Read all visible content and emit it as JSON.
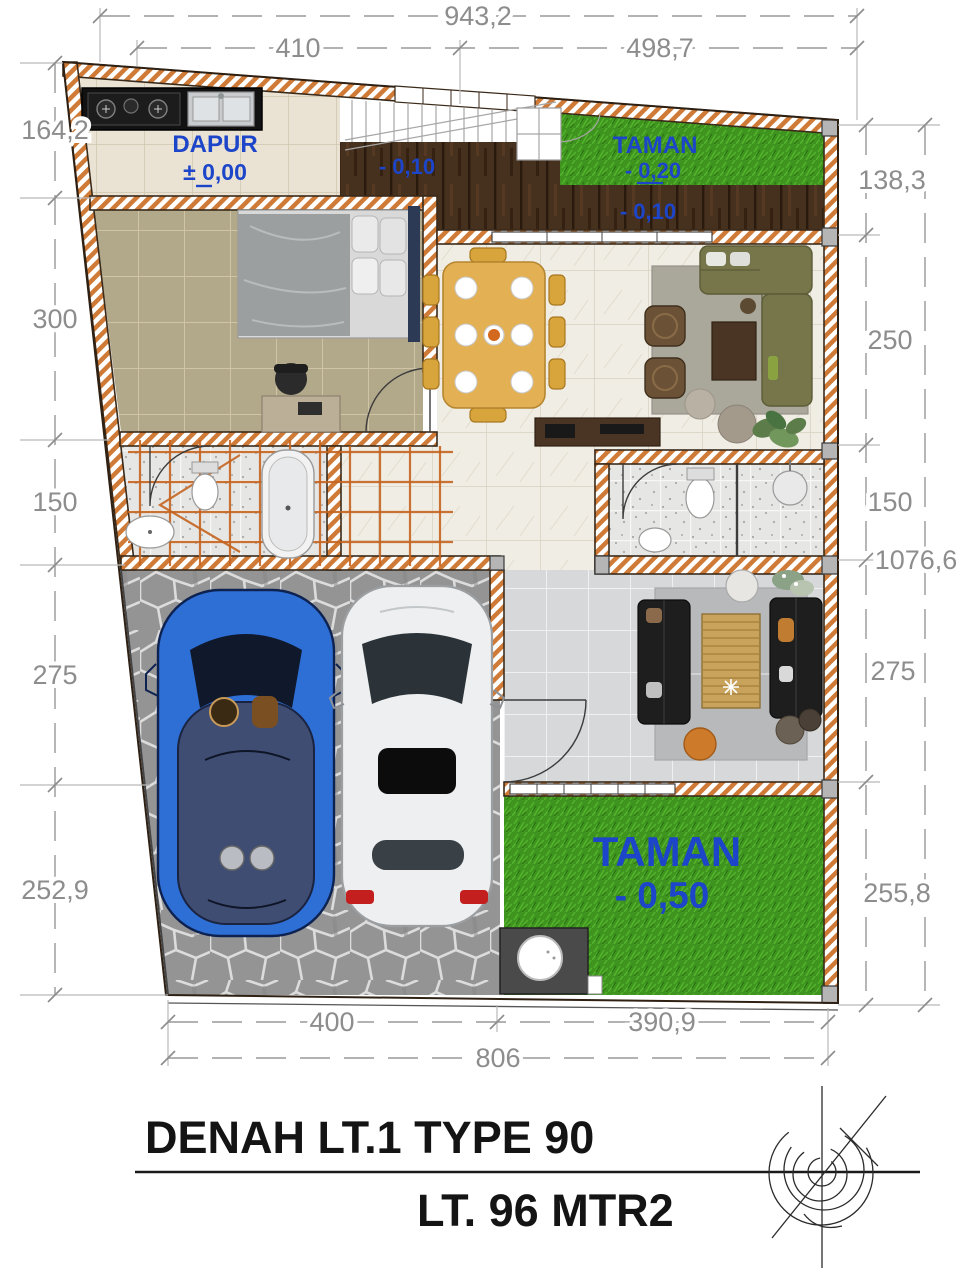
{
  "colors": {
    "label_blue": "#1c45c9",
    "dimension_gray": "#8d8d8d",
    "wall_hatch_orange": "#cf7a36",
    "grass_green": "#3f9420",
    "deck_brown": "#46301e",
    "title_black": "#141414"
  },
  "plan": {
    "rooms": {
      "kitchen": {
        "label": "DAPUR",
        "level": "± 0,00"
      },
      "garden_top": {
        "label": "TAMAN",
        "level": "- 0,20"
      },
      "deck_left": {
        "level": "- 0,10"
      },
      "deck_right": {
        "level": "- 0,10"
      },
      "garden_bottom": {
        "label": "TAMAN",
        "level": "- 0,50"
      }
    }
  },
  "dimensions": {
    "top_overall": "943,2",
    "top_segments": [
      "410",
      "498,7"
    ],
    "left": [
      "164,2",
      "300",
      "150",
      "275",
      "252,9"
    ],
    "right": [
      "138,3",
      "250",
      "150",
      "275",
      "255,8"
    ],
    "right_overall": "1076,6",
    "bottom_segments": [
      "400",
      "390,9"
    ],
    "bottom_overall": "806"
  },
  "title_block": {
    "line1": "DENAH LT.1 TYPE 90",
    "line2": "LT. 96 MTR2"
  }
}
